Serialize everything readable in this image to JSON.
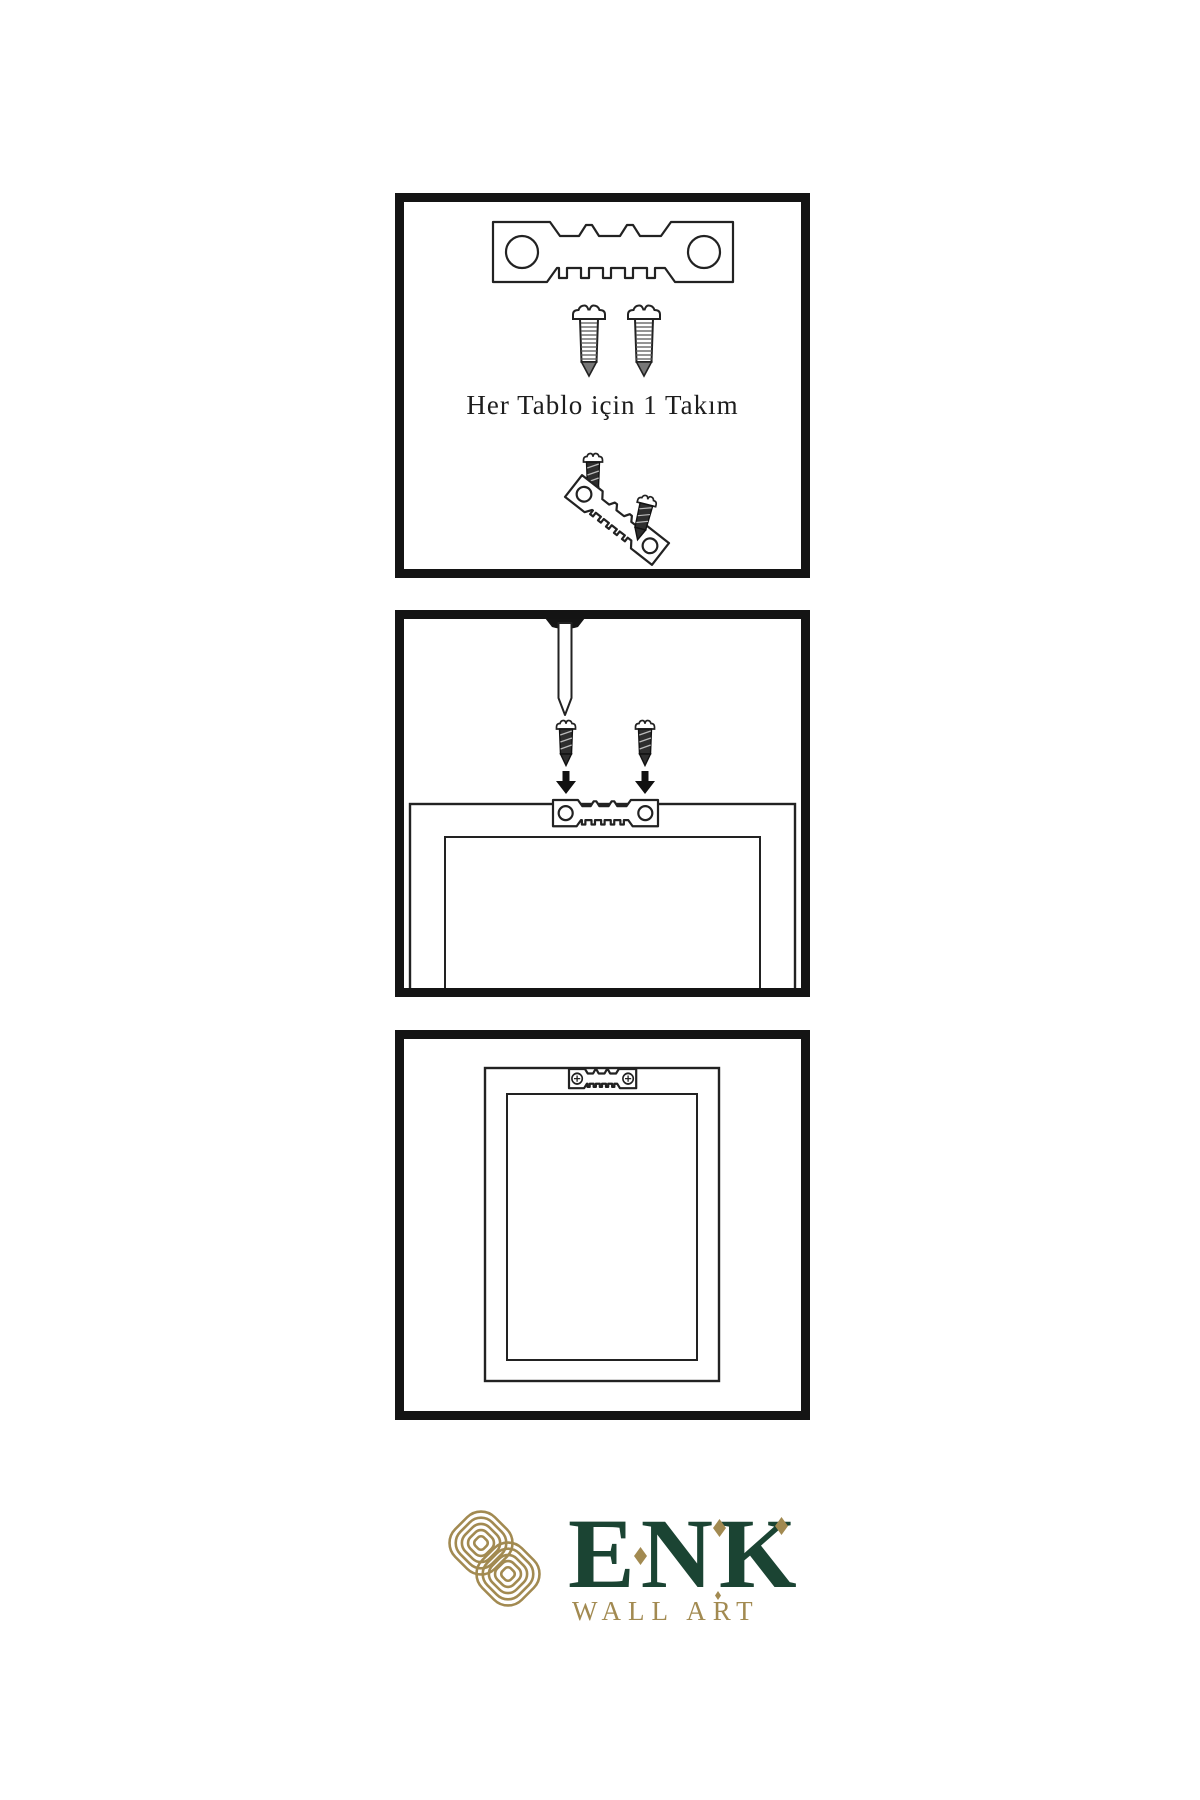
{
  "title": "Wall art hanging instruction sheet",
  "colors": {
    "background": "#ffffff",
    "line": "#222222",
    "panel_border": "#141414",
    "dark_metal": "#2e2e2e",
    "logo_green": "#1b4433",
    "logo_gold": "#a28a51"
  },
  "panels": {
    "step1": {
      "caption": "Her Tablo için 1 Takım",
      "contents": [
        "sawtooth-hanger",
        "two screws",
        "screw driven into tilted sawtooth hanger",
        "extra screw"
      ]
    },
    "step2": {
      "contents": [
        "nail in wall",
        "two screws with down arrows",
        "frame back with sawtooth hanger"
      ]
    },
    "step3": {
      "contents": [
        "frame back with sawtooth hanger fastened by two screws"
      ]
    }
  },
  "logo": {
    "brand": "ENK",
    "subtitle": "WALL ART"
  },
  "icons": {
    "sawtooth-hanger-icon": "plate with two round holes and serrated edge (svg path)",
    "screw-icon": "pan-head screw with threaded shank (svg path)",
    "dark-screw-icon": "short dark screw (svg path)",
    "nail-icon": "nail with black head (svg path)",
    "down-arrow-icon": "solid black downward arrow (svg path)",
    "phillips-head-icon": "circle with cross (svg)",
    "knot-emblem-icon": "two interlaced rounded-diamond spirals (svg)",
    "diamond-accent-icon": "gold rhombus (css clip-path)"
  }
}
